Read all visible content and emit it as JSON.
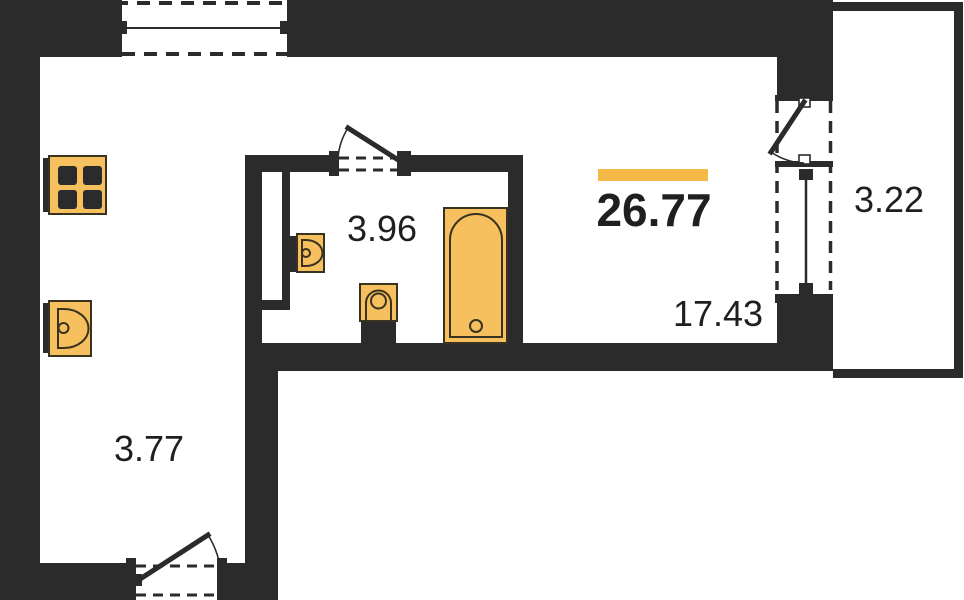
{
  "plan": {
    "total": {
      "area": "26.77"
    },
    "rooms": [
      {
        "name": "living-room",
        "area": "17.43"
      },
      {
        "name": "bathroom",
        "area": "3.96"
      },
      {
        "name": "hallway",
        "area": "3.77"
      },
      {
        "name": "balcony",
        "area": "3.22"
      }
    ]
  },
  "fixtures": [
    "stove-icon",
    "kitchen-sink-icon",
    "bathroom-sink-icon",
    "toilet-icon",
    "bathtub-icon",
    "top-window-icon",
    "balcony-window-icon",
    "entry-door-icon",
    "bathroom-door-icon",
    "balcony-door-icon"
  ],
  "colors": {
    "wall": "#2b2b2b",
    "fixture": "#f6c05e",
    "fixture-stroke": "#3a3220",
    "accent": "#f5ba45",
    "text": "#1f1f1f",
    "bg": "#ffffff"
  }
}
